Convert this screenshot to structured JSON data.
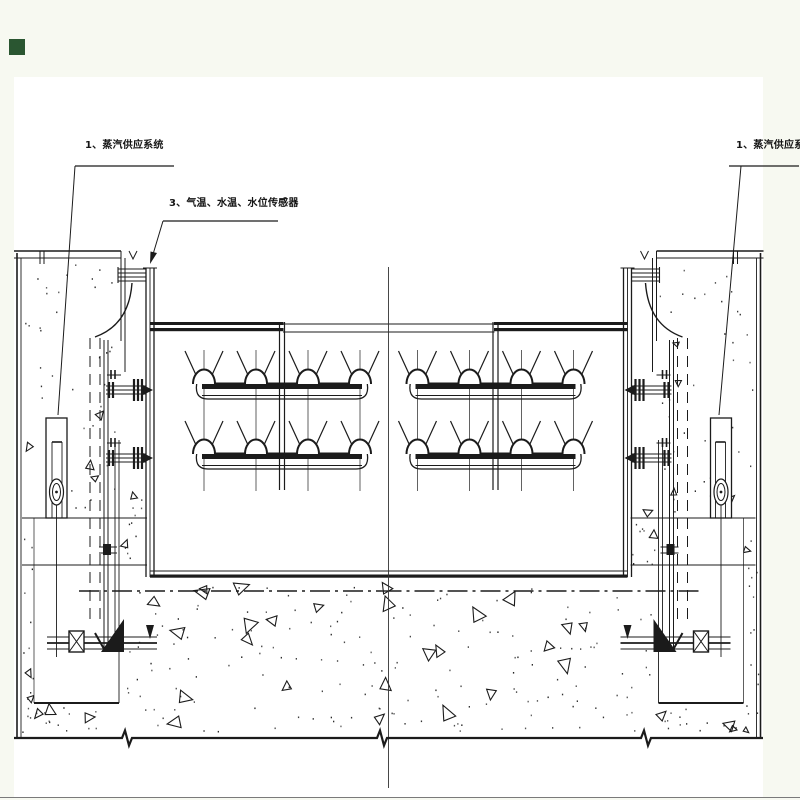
{
  "colors": {
    "background": "#f7f9f1",
    "paper": "#ffffff",
    "ink": "#1b1b1b",
    "marker_green": "#2a5631"
  },
  "labels": {
    "steam_supply_left": "1、蒸汽供应系统",
    "sensors": "3、气温、水温、水位传感器",
    "steam_supply_right": "1、蒸汽供应系统"
  }
}
